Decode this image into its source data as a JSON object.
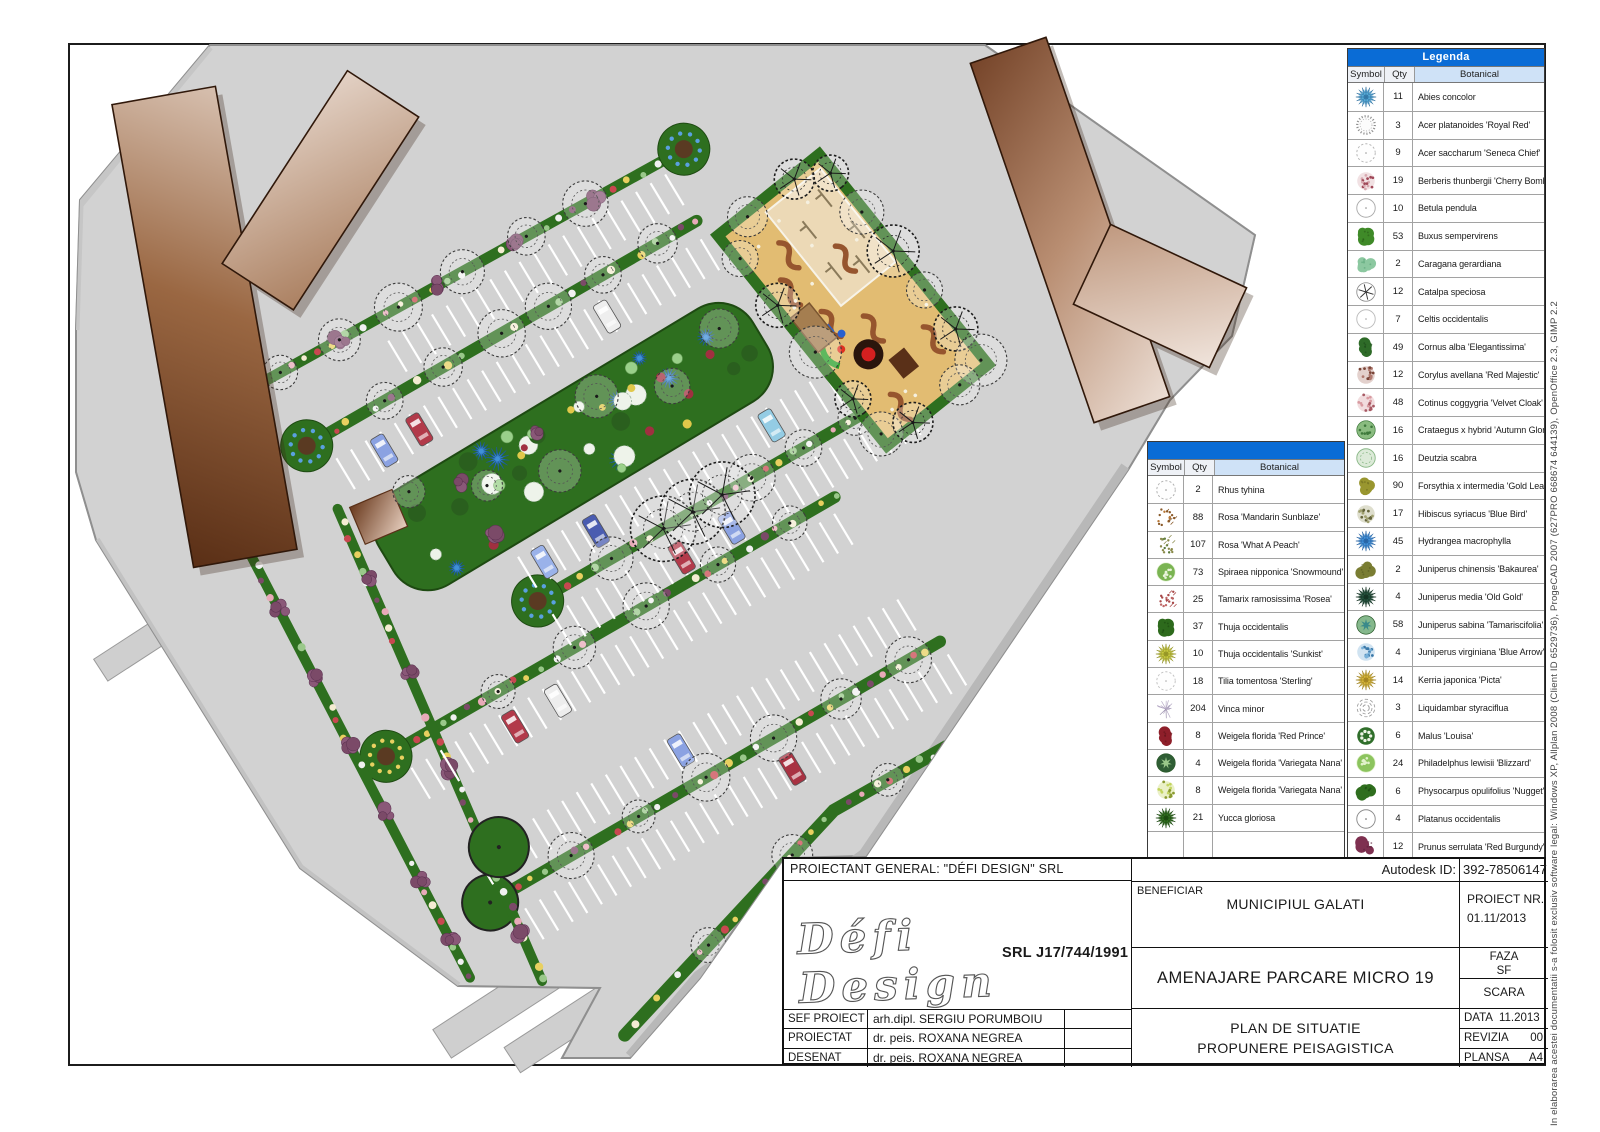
{
  "side_note": "In elaborarea acestei documentatii s-a folosit exclusiv software legal: Windows XP, Allplan 2008 (Client ID 6529736), ProgeCAD 2007 (627PRO 668674 644139), OpenOffice 2.3, GIMP 2.2",
  "colors": {
    "legend_header_blue": "#0a6cd6",
    "column_header_blue": "#cfe2f7",
    "pavement_gray": "#d2d2d2",
    "strip_green": "#2e6f1f",
    "playground_sand": "#e2bc72",
    "building_brown_dark": "#5a2f16",
    "building_brown_light": "#f3e9e2"
  },
  "legend_right": {
    "title": "Legenda",
    "columns": [
      "Symbol",
      "Qty",
      "Botanical"
    ],
    "rows": [
      {
        "qty": "11",
        "name": "Abies concolor",
        "sym": [
          "spiky",
          "#55aad6",
          "#2a6a9a"
        ]
      },
      {
        "qty": "3",
        "name": "Acer platanoides 'Royal Red'",
        "sym": [
          "scallop",
          "#8f8f8f",
          ""
        ]
      },
      {
        "qty": "9",
        "name": "Acer saccharum 'Seneca Chief'",
        "sym": [
          "dashed",
          "#b5b5b5",
          ""
        ]
      },
      {
        "qty": "19",
        "name": "Berberis thunbergii 'Cherry Bomb'",
        "sym": [
          "mottled",
          "#d8a8b0",
          "#a04858"
        ]
      },
      {
        "qty": "10",
        "name": "Betula pendula",
        "sym": [
          "outline",
          "#aaaaaa",
          ""
        ]
      },
      {
        "qty": "53",
        "name": "Buxus sempervirens",
        "sym": [
          "blob",
          "#3f8a28",
          "#2a5e18"
        ]
      },
      {
        "qty": "2",
        "name": "Caragana gerardiana",
        "sym": [
          "blob",
          "#8cc8a0",
          "#5aa578"
        ]
      },
      {
        "qty": "12",
        "name": "Catalpa speciosa",
        "sym": [
          "branches",
          "#555555",
          ""
        ]
      },
      {
        "qty": "7",
        "name": "Celtis occidentalis",
        "sym": [
          "outline",
          "#bcbcbc",
          ""
        ]
      },
      {
        "qty": "49",
        "name": "Cornus alba 'Elegantissima'",
        "sym": [
          "blob",
          "#2e6b28",
          "#1d4a1a"
        ]
      },
      {
        "qty": "12",
        "name": "Corylus avellana 'Red Majestic'",
        "sym": [
          "mottled",
          "#b07a70",
          "#7a4538"
        ]
      },
      {
        "qty": "48",
        "name": "Cotinus coggygria 'Velvet Cloak'",
        "sym": [
          "mottled",
          "#d89aa0",
          "#a85a64"
        ]
      },
      {
        "qty": "16",
        "name": "Crataegus x hybrid 'Autumn Glory'",
        "sym": [
          "dots-in",
          "#8abc80",
          "#3f7a3c"
        ]
      },
      {
        "qty": "16",
        "name": "Deutzia scabra",
        "sym": [
          "ring",
          "#dcead8",
          "#8ab887"
        ]
      },
      {
        "qty": "90",
        "name": "Forsythia x intermedia 'Gold Leaf'",
        "sym": [
          "blob",
          "#99962f",
          "#6f6d1f"
        ]
      },
      {
        "qty": "17",
        "name": "Hibiscus syriacus 'Blue Bird'",
        "sym": [
          "mottled",
          "#a0a070",
          "#64643c"
        ]
      },
      {
        "qty": "45",
        "name": "Hydrangea macrophylla",
        "sym": [
          "spiky",
          "#4090d8",
          "#205a9a"
        ]
      },
      {
        "qty": "2",
        "name": "Juniperus chinensis 'Bakaurea'",
        "sym": [
          "blob",
          "#7a7d33",
          "#565a1f"
        ]
      },
      {
        "qty": "4",
        "name": "Juniperus media 'Old Gold'",
        "sym": [
          "spiky",
          "#24523e",
          "#102c1e"
        ]
      },
      {
        "qty": "58",
        "name": "Juniperus sabina 'Tamariscifolia'",
        "sym": [
          "ring-star",
          "#85b88c",
          "#3a8a8a"
        ]
      },
      {
        "qty": "4",
        "name": "Juniperus virginiana 'Blue Arrow'",
        "sym": [
          "mottled",
          "#78b0d8",
          "#3a78a8"
        ]
      },
      {
        "qty": "14",
        "name": "Kerria japonica 'Picta'",
        "sym": [
          "spiky",
          "#d4b438",
          "#96781a"
        ]
      },
      {
        "qty": "3",
        "name": "Liquidambar styraciflua",
        "sym": [
          "scribble",
          "#9a9a9a",
          ""
        ]
      },
      {
        "qty": "6",
        "name": "Malus 'Louisa'",
        "sym": [
          "flower",
          "#2f6e2a",
          "#eef4e6"
        ]
      },
      {
        "qty": "24",
        "name": "Philadelphus lewisii 'Blizzard'",
        "sym": [
          "dots-in",
          "#8cc45e",
          "#e2f2cc"
        ]
      },
      {
        "qty": "6",
        "name": "Physocarpus opulifolius 'Nugget'",
        "sym": [
          "blob",
          "#2f6e1e",
          "#1d4a12"
        ]
      },
      {
        "qty": "4",
        "name": "Platanus occidentalis",
        "sym": [
          "outline",
          "#8a8a8a",
          ""
        ]
      },
      {
        "qty": "12",
        "name": "Prunus serrulata 'Red Burgundy'",
        "sym": [
          "blob",
          "#7e3050",
          "#5a1f38"
        ]
      }
    ]
  },
  "legend_middle": {
    "title": "",
    "columns": [
      "Symbol",
      "Qty",
      "Botanical"
    ],
    "rows": [
      {
        "qty": "2",
        "name": "Rhus tyhina",
        "sym": [
          "dashed",
          "#b0b0b0",
          ""
        ]
      },
      {
        "qty": "88",
        "name": "Rosa 'Mandarin Sunblaze'",
        "sym": [
          "scatter",
          "#8a5a2a",
          "#b87838"
        ]
      },
      {
        "qty": "107",
        "name": "Rosa 'What A Peach'",
        "sym": [
          "scatter",
          "#8a8a4a",
          "#5a7a3a"
        ]
      },
      {
        "qty": "73",
        "name": "Spiraea nipponica 'Snowmound'",
        "sym": [
          "dots-in",
          "#7ab452",
          "#e8f4da"
        ]
      },
      {
        "qty": "25",
        "name": "Tamarix ramosissima 'Rosea'",
        "sym": [
          "scatter",
          "#a84848",
          "#c06868"
        ]
      },
      {
        "qty": "37",
        "name": "Thuja occidentalis",
        "sym": [
          "blob",
          "#2d6a1c",
          "#1a4a10"
        ]
      },
      {
        "qty": "10",
        "name": "Thuja occidentalis 'Sunkist'",
        "sym": [
          "spiky",
          "#c6c83e",
          "#8a8a20"
        ]
      },
      {
        "qty": "18",
        "name": "Tilia tomentosa 'Sterling'",
        "sym": [
          "dashed",
          "#c2c2c2",
          ""
        ]
      },
      {
        "qty": "204",
        "name": "Vinca minor",
        "sym": [
          "wisp",
          "#b4a8c4",
          "#9488a8"
        ]
      },
      {
        "qty": "8",
        "name": "Weigela florida 'Red Prince'",
        "sym": [
          "blob",
          "#8e1f2a",
          "#63141d"
        ]
      },
      {
        "qty": "4",
        "name": "Weigela florida 'Variegata Nana'",
        "sym": [
          "ring-star",
          "#2f5e35",
          "#9ac88a"
        ]
      },
      {
        "qty": "8",
        "name": "Weigela florida 'Variegata Nana'",
        "sym": [
          "mottled",
          "#c2d45e",
          "#8a9a30"
        ]
      },
      {
        "qty": "21",
        "name": "Yucca gloriosa",
        "sym": [
          "spiky",
          "#2f6e1e",
          "#16400c"
        ]
      },
      {
        "qty": "",
        "name": "",
        "sym": [
          "none",
          "",
          ""
        ]
      }
    ]
  },
  "title_block": {
    "proiectant": "PROIECTANT GENERAL: \"DÉFI DESIGN\" SRL",
    "logo_script": "Défi Design",
    "logo_srl": "SRL  J17/744/1991",
    "autodesk_label": "Autodesk ID:",
    "autodesk_value": "392-78506147",
    "beneficiar_label": "BENEFICIAR",
    "beneficiar_value": "MUNICIPIUL GALATI",
    "proiect_nr_label": "PROIECT NR.",
    "proiect_nr_value": "01.11/2013",
    "project_title": "AMENAJARE PARCARE MICRO 19",
    "faza_label": "FAZA",
    "faza_value": "SF",
    "scara_label": "SCARA",
    "staff": [
      {
        "label": "SEF PROIECT",
        "value": "arh.dipl. SERGIU PORUMBOIU"
      },
      {
        "label": "PROIECTAT",
        "value": "dr. peis. ROXANA NEGREA"
      },
      {
        "label": "DESENAT",
        "value": "dr. peis. ROXANA NEGREA"
      }
    ],
    "plan_title_line1": "PLAN DE SITUATIE",
    "plan_title_line2": "PROPUNERE PEISAGISTICA",
    "data_label": "DATA",
    "data_value": "11.2013",
    "revizia_label": "REVIZIA",
    "revizia_value": "00",
    "plansa_label": "PLANSA",
    "plansa_value": "A4"
  }
}
